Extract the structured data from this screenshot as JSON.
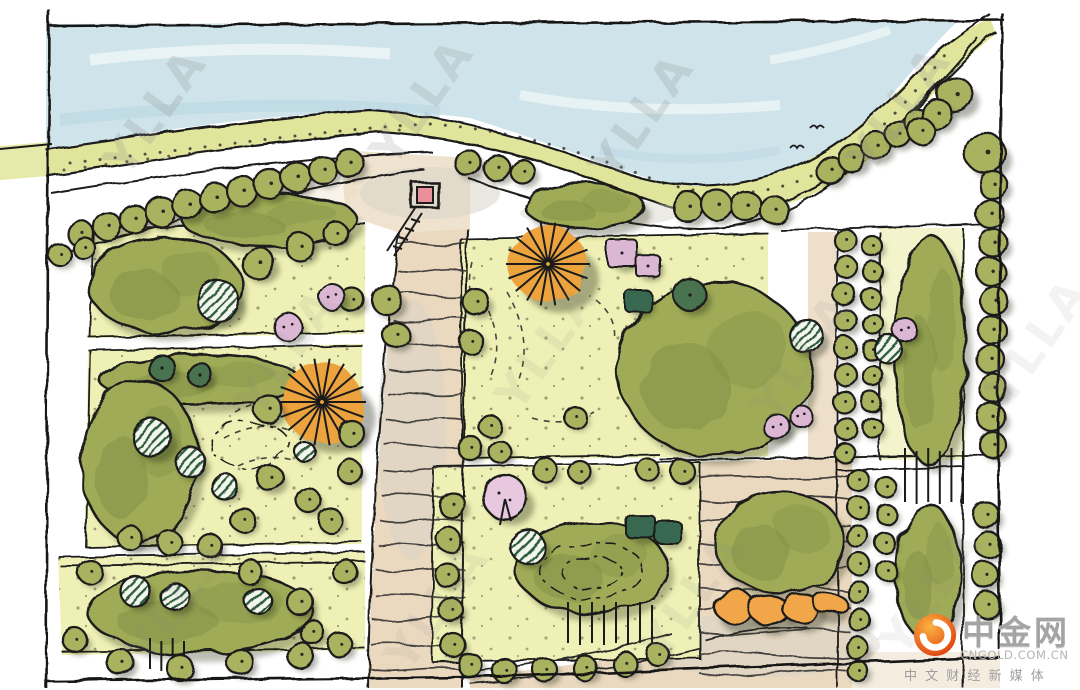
{
  "watermark": {
    "text": "YLLA"
  },
  "logo": {
    "brand": "中金网",
    "domain": "CNGOLD.COM.CN",
    "tagline": "中 文 财 经 新 媒 体",
    "icon": "orange-swirl-flame",
    "icon_colors": [
      "#f9b342",
      "#ed7224",
      "#d93c12"
    ]
  },
  "palette": {
    "ink": "#1b1b1b",
    "paper": "#ffffff",
    "river": "#cfe4ea",
    "riverDeep": "#bcd9e2",
    "bank": "#e0e59b",
    "lawn": "#eef0b5",
    "roadTan": "#ead9bf",
    "roadGray": "#d7d3c7",
    "olive": "#a9b25f",
    "canopy": "#9fab56",
    "canopyDark": "#84934a",
    "conifer": "#4a7350",
    "teal": "#39684f",
    "orange": "#eda33d",
    "orangeLight": "#f0a64a",
    "pink": "#dcb7d4",
    "pinkLight": "#e8c8de",
    "watermarkGray": "#8a8a8a"
  },
  "scene": {
    "watermarks": [
      [
        168,
        120,
        0.22
      ],
      [
        435,
        110,
        0.2
      ],
      [
        655,
        125,
        0.22
      ],
      [
        912,
        118,
        0.2
      ],
      [
        300,
        360,
        0.1
      ],
      [
        560,
        355,
        0.1
      ],
      [
        815,
        365,
        0.1
      ],
      [
        1050,
        350,
        0.1
      ],
      [
        190,
        610,
        0.1
      ],
      [
        450,
        615,
        0.1
      ],
      [
        705,
        605,
        0.1
      ],
      [
        945,
        600,
        0.1
      ]
    ],
    "birds": [
      [
        817,
        128
      ],
      [
        797,
        148
      ]
    ],
    "masses": [
      [
        270,
        220,
        88,
        26
      ],
      [
        585,
        207,
        60,
        22
      ],
      [
        165,
        285,
        76,
        48
      ],
      [
        200,
        380,
        100,
        25
      ],
      [
        140,
        462,
        58,
        82
      ],
      [
        200,
        612,
        112,
        42
      ],
      [
        715,
        370,
        97,
        87
      ],
      [
        592,
        568,
        76,
        46
      ],
      [
        780,
        542,
        66,
        51
      ],
      [
        930,
        350,
        36,
        115
      ],
      [
        928,
        572,
        33,
        68
      ]
    ],
    "trees": [
      [
        "olive",
        80,
        233,
        13
      ],
      [
        "olive",
        107,
        226,
        14
      ],
      [
        "olive",
        134,
        219,
        14
      ],
      [
        "olive",
        161,
        212,
        15
      ],
      [
        "olive",
        188,
        205,
        15
      ],
      [
        "olive",
        215,
        198,
        15
      ],
      [
        "olive",
        242,
        191,
        15
      ],
      [
        "olive",
        269,
        184,
        15
      ],
      [
        "olive",
        296,
        177,
        15
      ],
      [
        "olive",
        323,
        170,
        14
      ],
      [
        "olive",
        349,
        163,
        14
      ],
      [
        "olive",
        60,
        255,
        11
      ],
      [
        "olive",
        84,
        248,
        11
      ],
      [
        "olive",
        468,
        163,
        13
      ],
      [
        "olive",
        497,
        168,
        13
      ],
      [
        "olive",
        523,
        172,
        12
      ],
      [
        "olive",
        688,
        207,
        15
      ],
      [
        "olive",
        717,
        205,
        15
      ],
      [
        "olive",
        746,
        206,
        15
      ],
      [
        "olive",
        774,
        210,
        14
      ],
      [
        "olive",
        830,
        170,
        14
      ],
      [
        "olive",
        852,
        158,
        14
      ],
      [
        "olive",
        876,
        146,
        14
      ],
      [
        "olive",
        898,
        134,
        13
      ],
      [
        "olive",
        918,
        122,
        13
      ],
      [
        "olive",
        955,
        95,
        18
      ],
      [
        "olive",
        937,
        114,
        15
      ],
      [
        "olive",
        921,
        131,
        13
      ],
      [
        "olive",
        985,
        153,
        20
      ],
      [
        "olive",
        993,
        185,
        14
      ],
      [
        "olive",
        990,
        214,
        14
      ],
      [
        "olive",
        993,
        243,
        14
      ],
      [
        "olive",
        991,
        272,
        14
      ],
      [
        "olive",
        994,
        301,
        14
      ],
      [
        "olive",
        992,
        330,
        14
      ],
      [
        "olive",
        990,
        359,
        14
      ],
      [
        "olive",
        993,
        388,
        14
      ],
      [
        "olive",
        991,
        417,
        14
      ],
      [
        "olive",
        993,
        445,
        13
      ],
      [
        "olive",
        986,
        515,
        13
      ],
      [
        "olive",
        988,
        545,
        13
      ],
      [
        "olive",
        985,
        575,
        13
      ],
      [
        "olive",
        987,
        605,
        13
      ],
      [
        "olive",
        845,
        240,
        11
      ],
      [
        "olive",
        846,
        267,
        11
      ],
      [
        "olive",
        844,
        294,
        11
      ],
      [
        "olive",
        846,
        321,
        11
      ],
      [
        "olive",
        845,
        348,
        11
      ],
      [
        "olive",
        846,
        375,
        11
      ],
      [
        "olive",
        844,
        402,
        11
      ],
      [
        "olive",
        846,
        429,
        11
      ],
      [
        "olive",
        845,
        453,
        10
      ],
      [
        "olive",
        872,
        246,
        10
      ],
      [
        "olive",
        873,
        272,
        10
      ],
      [
        "olive",
        871,
        298,
        10
      ],
      [
        "olive",
        873,
        324,
        10
      ],
      [
        "olive",
        872,
        350,
        10
      ],
      [
        "olive",
        873,
        376,
        10
      ],
      [
        "olive",
        871,
        402,
        10
      ],
      [
        "olive",
        873,
        428,
        10
      ],
      [
        "olive",
        858,
        480,
        11
      ],
      [
        "olive",
        859,
        508,
        11
      ],
      [
        "olive",
        857,
        536,
        11
      ],
      [
        "olive",
        859,
        564,
        11
      ],
      [
        "olive",
        858,
        592,
        11
      ],
      [
        "olive",
        859,
        620,
        11
      ],
      [
        "olive",
        857,
        648,
        11
      ],
      [
        "olive",
        858,
        671,
        10
      ],
      [
        "olive",
        886,
        487,
        10
      ],
      [
        "olive",
        887,
        515,
        10
      ],
      [
        "olive",
        885,
        543,
        10
      ],
      [
        "olive",
        887,
        571,
        10
      ],
      [
        "hatch",
        218,
        301,
        21
      ],
      [
        "olive",
        258,
        263,
        16
      ],
      [
        "olive",
        300,
        247,
        14
      ],
      [
        "olive",
        336,
        234,
        12
      ],
      [
        "olive",
        352,
        300,
        12
      ],
      [
        "pink",
        332,
        297,
        13
      ],
      [
        "pink",
        288,
        327,
        14
      ],
      [
        "olive",
        387,
        300,
        15
      ],
      [
        "olive",
        396,
        335,
        13
      ],
      [
        "olive",
        476,
        302,
        13
      ],
      [
        "olive",
        471,
        342,
        12
      ],
      [
        "dark",
        162,
        368,
        13
      ],
      [
        "dark",
        200,
        375,
        12
      ],
      [
        "sun",
        322,
        402,
        40
      ],
      [
        "hatch",
        152,
        438,
        19
      ],
      [
        "hatch",
        190,
        462,
        15
      ],
      [
        "hatch",
        224,
        486,
        13
      ],
      [
        "hatch",
        305,
        452,
        10
      ],
      [
        "olive",
        268,
        409,
        14
      ],
      [
        "olive",
        270,
        478,
        13
      ],
      [
        "olive",
        308,
        500,
        12
      ],
      [
        "olive",
        243,
        520,
        12
      ],
      [
        "olive",
        352,
        434,
        13
      ],
      [
        "olive",
        350,
        472,
        12
      ],
      [
        "olive",
        330,
        520,
        12
      ],
      [
        "olive",
        130,
        538,
        12
      ],
      [
        "olive",
        170,
        543,
        12
      ],
      [
        "olive",
        210,
        546,
        12
      ],
      [
        "hatch",
        135,
        591,
        15
      ],
      [
        "hatch",
        175,
        597,
        14
      ],
      [
        "hatch",
        258,
        601,
        13
      ],
      [
        "olive",
        90,
        572,
        12
      ],
      [
        "olive",
        250,
        572,
        12
      ],
      [
        "olive",
        345,
        572,
        12
      ],
      [
        "olive",
        300,
        602,
        13
      ],
      [
        "olive",
        312,
        632,
        12
      ],
      [
        "olive",
        75,
        640,
        12
      ],
      [
        "olive",
        120,
        662,
        13
      ],
      [
        "olive",
        180,
        668,
        13
      ],
      [
        "olive",
        240,
        662,
        13
      ],
      [
        "olive",
        300,
        655,
        13
      ],
      [
        "olive",
        340,
        645,
        12
      ],
      [
        "sun",
        548,
        264,
        38
      ],
      [
        "pinkq",
        622,
        253,
        15
      ],
      [
        "pinkq",
        648,
        266,
        12
      ],
      [
        "teal",
        638,
        301,
        13
      ],
      [
        "dark",
        690,
        295,
        16
      ],
      [
        "hatch",
        806,
        336,
        17
      ],
      [
        "pink",
        777,
        427,
        13
      ],
      [
        "pink",
        801,
        416,
        11
      ],
      [
        "olive",
        575,
        417,
        11
      ],
      [
        "olive",
        490,
        426,
        11
      ],
      [
        "olive",
        470,
        448,
        12
      ],
      [
        "olive",
        500,
        452,
        11
      ],
      [
        "pinktree",
        505,
        497,
        22
      ],
      [
        "hatch",
        528,
        547,
        17
      ],
      [
        "teal",
        641,
        527,
        14
      ],
      [
        "teal",
        668,
        532,
        13
      ],
      [
        "olive",
        452,
        505,
        13
      ],
      [
        "olive",
        449,
        540,
        12
      ],
      [
        "olive",
        447,
        575,
        12
      ],
      [
        "olive",
        451,
        610,
        12
      ],
      [
        "olive",
        453,
        645,
        12
      ],
      [
        "olive",
        470,
        665,
        12
      ],
      [
        "olive",
        505,
        671,
        12
      ],
      [
        "olive",
        545,
        670,
        12
      ],
      [
        "olive",
        585,
        668,
        12
      ],
      [
        "olive",
        625,
        664,
        12
      ],
      [
        "olive",
        658,
        655,
        11
      ],
      [
        "olive",
        683,
        472,
        12
      ],
      [
        "olive",
        648,
        470,
        11
      ],
      [
        "olive",
        545,
        470,
        12
      ],
      [
        "olive",
        580,
        472,
        11
      ],
      [
        "oscallop",
        735,
        607,
        21
      ],
      [
        "oscallop",
        769,
        610,
        20
      ],
      [
        "oscallop",
        801,
        608,
        19
      ],
      [
        "oscallop",
        829,
        603,
        16
      ],
      [
        "pink",
        905,
        330,
        12
      ],
      [
        "hatch",
        888,
        349,
        14
      ]
    ],
    "steps": [
      [
        905,
        448,
        58,
        56,
        6
      ],
      [
        568,
        602,
        84,
        43,
        8
      ],
      [
        150,
        638,
        34,
        33,
        4
      ]
    ],
    "roadWaves": {
      "ys": [
        245,
        270,
        295,
        320,
        345,
        370,
        395,
        420,
        445,
        470,
        495,
        520,
        545,
        570,
        595,
        620,
        645,
        668
      ]
    },
    "plazaWaves": {
      "ys": [
        478,
        500,
        522,
        544,
        566,
        588,
        610,
        632,
        654,
        674
      ],
      "x1": 700,
      "x2": 850
    }
  }
}
